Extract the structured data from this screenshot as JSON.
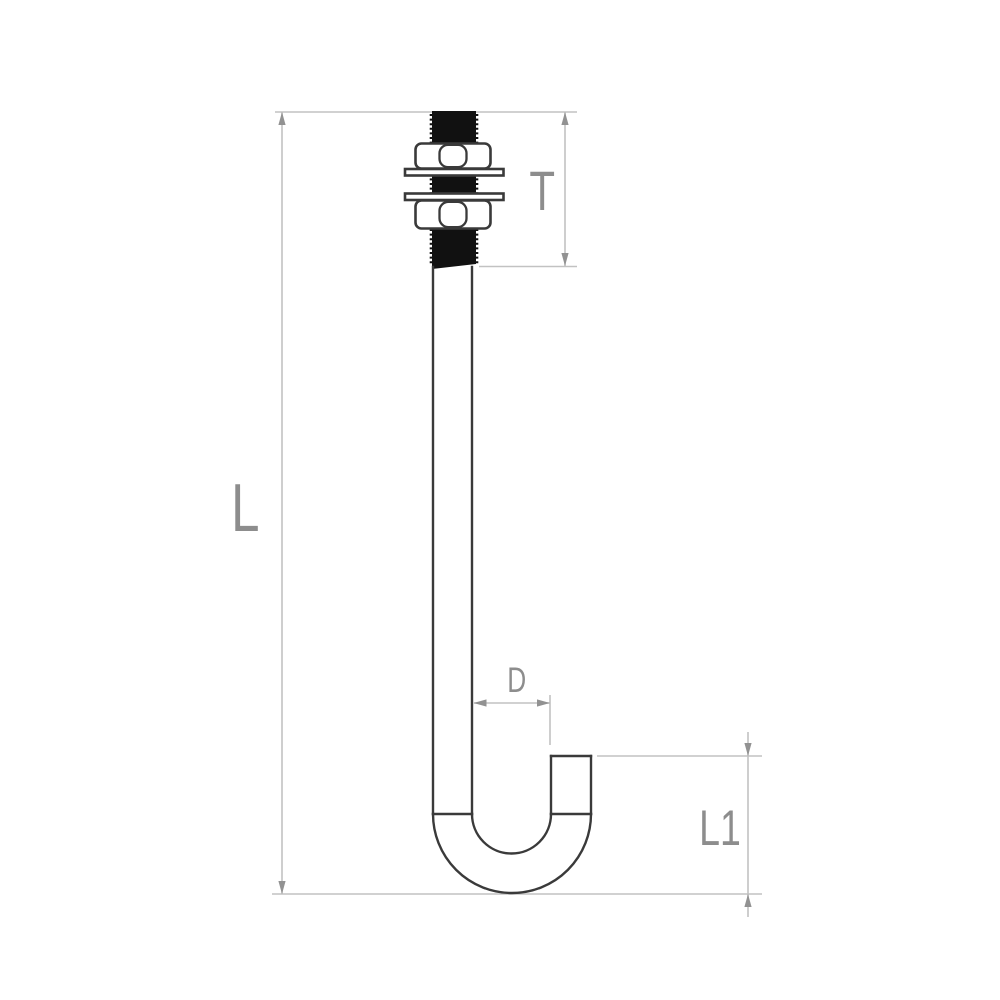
{
  "drawing": {
    "type": "technical-dimension-drawing",
    "part": "j-bolt-hook-bolt-with-two-hex-nuts-and-two-washers",
    "labels": {
      "overall_length": "L",
      "thread_length": "T",
      "hook_inner_diameter": "D",
      "hook_height": "L1"
    },
    "colors": {
      "background": "#ffffff",
      "outline": "#3a3a3a",
      "thread_fill": "#111111",
      "dimension_line": "#c2c2c2",
      "arrow": "#929292",
      "label_text": "#8d8d8d"
    }
  }
}
